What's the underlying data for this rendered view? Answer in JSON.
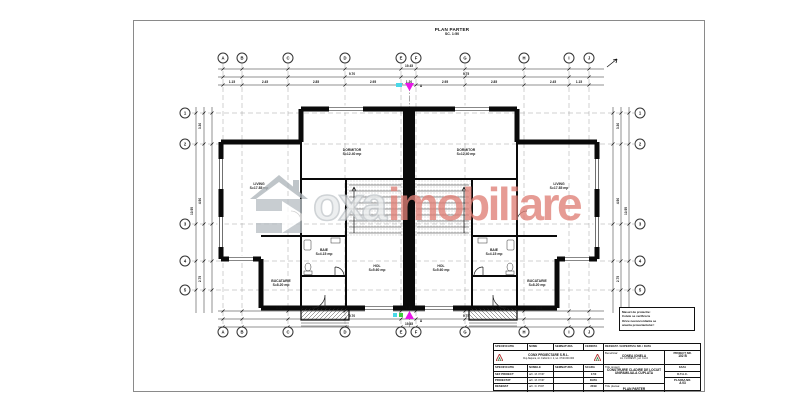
{
  "sheet_title": {
    "line1": "PLAN PARTER",
    "line2": "SC. 1:50"
  },
  "watermark": {
    "logo": "house-arrow",
    "word_gray": "oxa",
    "word_red": "imobiliare"
  },
  "bubbles": [
    {
      "label": "A",
      "x": 89,
      "y": 37
    },
    {
      "label": "B",
      "x": 108,
      "y": 37
    },
    {
      "label": "C",
      "x": 154,
      "y": 37
    },
    {
      "label": "D",
      "x": 211,
      "y": 37
    },
    {
      "label": "E",
      "x": 267,
      "y": 37
    },
    {
      "label": "F",
      "x": 282,
      "y": 37
    },
    {
      "label": "G",
      "x": 331,
      "y": 37
    },
    {
      "label": "H",
      "x": 390,
      "y": 37
    },
    {
      "label": "I",
      "x": 435,
      "y": 37
    },
    {
      "label": "J",
      "x": 455,
      "y": 37
    },
    {
      "label": "A",
      "x": 89,
      "y": 311
    },
    {
      "label": "B",
      "x": 108,
      "y": 311
    },
    {
      "label": "C",
      "x": 154,
      "y": 311
    },
    {
      "label": "D",
      "x": 211,
      "y": 311
    },
    {
      "label": "E",
      "x": 267,
      "y": 311
    },
    {
      "label": "F",
      "x": 282,
      "y": 311
    },
    {
      "label": "G",
      "x": 331,
      "y": 311
    },
    {
      "label": "H",
      "x": 390,
      "y": 311
    },
    {
      "label": "I",
      "x": 435,
      "y": 311
    },
    {
      "label": "J",
      "x": 455,
      "y": 311
    },
    {
      "label": "1",
      "x": 51,
      "y": 92
    },
    {
      "label": "2",
      "x": 51,
      "y": 123
    },
    {
      "label": "3",
      "x": 51,
      "y": 203
    },
    {
      "label": "4",
      "x": 51,
      "y": 240
    },
    {
      "label": "5",
      "x": 51,
      "y": 269
    },
    {
      "label": "1",
      "x": 506,
      "y": 92
    },
    {
      "label": "2",
      "x": 506,
      "y": 123
    },
    {
      "label": "3",
      "x": 506,
      "y": 203
    },
    {
      "label": "4",
      "x": 506,
      "y": 240
    },
    {
      "label": "5",
      "x": 506,
      "y": 269
    }
  ],
  "rooms": [
    {
      "l1": "DORMITOR",
      "l2": "S=12.40 mp",
      "x": 218,
      "y": 131
    },
    {
      "l1": "LIVING",
      "l2": "S=17.85 mp",
      "x": 125,
      "y": 165
    },
    {
      "l1": "BUCATARIE",
      "l2": "S=8.20 mp",
      "x": 147,
      "y": 262
    },
    {
      "l1": "BAIE",
      "l2": "S=4.15 mp",
      "x": 190,
      "y": 231
    },
    {
      "l1": "HOL",
      "l2": "S=5.60 mp",
      "x": 243,
      "y": 247
    },
    {
      "l1": "DORMITOR",
      "l2": "S=12.40 mp",
      "x": 332,
      "y": 131
    },
    {
      "l1": "LIVING",
      "l2": "S=17.85 mp",
      "x": 425,
      "y": 165
    },
    {
      "l1": "BUCATARIE",
      "l2": "S=8.20 mp",
      "x": 403,
      "y": 262
    },
    {
      "l1": "BAIE",
      "l2": "S=4.15 mp",
      "x": 360,
      "y": 231
    },
    {
      "l1": "HOL",
      "l2": "S=5.60 mp",
      "x": 307,
      "y": 247
    }
  ],
  "dims": [
    {
      "t": "19.45",
      "x": 275,
      "y": 45
    },
    {
      "t": "9.70",
      "x": 218,
      "y": 53
    },
    {
      "t": "9.75",
      "x": 332,
      "y": 53
    },
    {
      "t": "1.15",
      "x": 98,
      "y": 61
    },
    {
      "t": "2.45",
      "x": 131,
      "y": 61
    },
    {
      "t": "2.85",
      "x": 182,
      "y": 61
    },
    {
      "t": "2.95",
      "x": 239,
      "y": 61
    },
    {
      "t": "1.20",
      "x": 275,
      "y": 61
    },
    {
      "t": "2.95",
      "x": 311,
      "y": 61
    },
    {
      "t": "2.85",
      "x": 360,
      "y": 61
    },
    {
      "t": "2.45",
      "x": 419,
      "y": 61
    },
    {
      "t": "1.15",
      "x": 445,
      "y": 61
    },
    {
      "t": "4.25",
      "x": 145,
      "y": 287
    },
    {
      "t": "2.40",
      "x": 191,
      "y": 287
    },
    {
      "t": "1.85",
      "x": 275,
      "y": 287
    },
    {
      "t": "2.40",
      "x": 359,
      "y": 287
    },
    {
      "t": "4.25",
      "x": 405,
      "y": 287
    },
    {
      "t": "9.70",
      "x": 218,
      "y": 295
    },
    {
      "t": "9.75",
      "x": 332,
      "y": 295
    },
    {
      "t": "19.45",
      "x": 275,
      "y": 303
    },
    {
      "t": "3.30",
      "x": 66,
      "y": 105,
      "rot": -90
    },
    {
      "t": "4.90",
      "x": 66,
      "y": 180,
      "rot": -90
    },
    {
      "t": "2.75",
      "x": 66,
      "y": 258,
      "rot": -90
    },
    {
      "t": "10.95",
      "x": 58,
      "y": 190,
      "rot": -90
    },
    {
      "t": "3.30",
      "x": 484,
      "y": 105,
      "rot": -90
    },
    {
      "t": "4.90",
      "x": 484,
      "y": 180,
      "rot": -90
    },
    {
      "t": "2.75",
      "x": 484,
      "y": 258,
      "rot": -90
    },
    {
      "t": "10.95",
      "x": 492,
      "y": 190,
      "rot": -90
    },
    {
      "t": "A",
      "x": 287,
      "y": 65
    },
    {
      "t": "A",
      "x": 287,
      "y": 300
    }
  ],
  "note": {
    "lines": [
      "Masuri de protectie:",
      "Cotele se verifica la",
      "Orice neconcordanta se",
      "anunta proiectantului !"
    ]
  },
  "title_block": {
    "r1c1": "SPECIFICATIE",
    "r1c2": "NUME",
    "r1c3": "SEMNATURA",
    "r1c4": "CERINTA",
    "r1c5": "REFERAT / EXPERTIZA NR. / DATA",
    "firm": "CONX PROIECTARE S.R.L.",
    "firm_sub": "Cluj-Napoca, str. Fabricii nr. 2, tel. 0740.000.000",
    "benef_label": "Beneficiar:",
    "benef": "CONEA IONELA",
    "benef_addr": "loc. FLORESTI, jud. CLUJ",
    "proj_label": "PROIECT NR.",
    "proj_no": "102 B",
    "r3c1": "SPECIFICATIE",
    "r3c2": "NUMELE",
    "r3c3": "SEMNATURA",
    "scara_label": "SCARA",
    "scara": "1:50",
    "title_label": "Titlu proiect:",
    "proj_title": "CONSTRUIRE CLADIRE DE LOCUIT UNIFAMILIALA CUPLATA",
    "faza_label": "FAZA",
    "faza": "D.T.A.C.",
    "sef_label": "SEF PROIECT",
    "sef": "arh. M. POP",
    "proiectat_label": "PROIECTAT",
    "proiectat": "arh. M. POP",
    "desenat_label": "DESENAT",
    "desenat": "arh. D. POP",
    "data_label": "DATA",
    "data": "2019",
    "plansa_label": "Titlu plansa:",
    "plansa_title": "PLAN PARTER",
    "plansa_no_label": "PLANSA NR.",
    "plansa_no": "A 03"
  }
}
